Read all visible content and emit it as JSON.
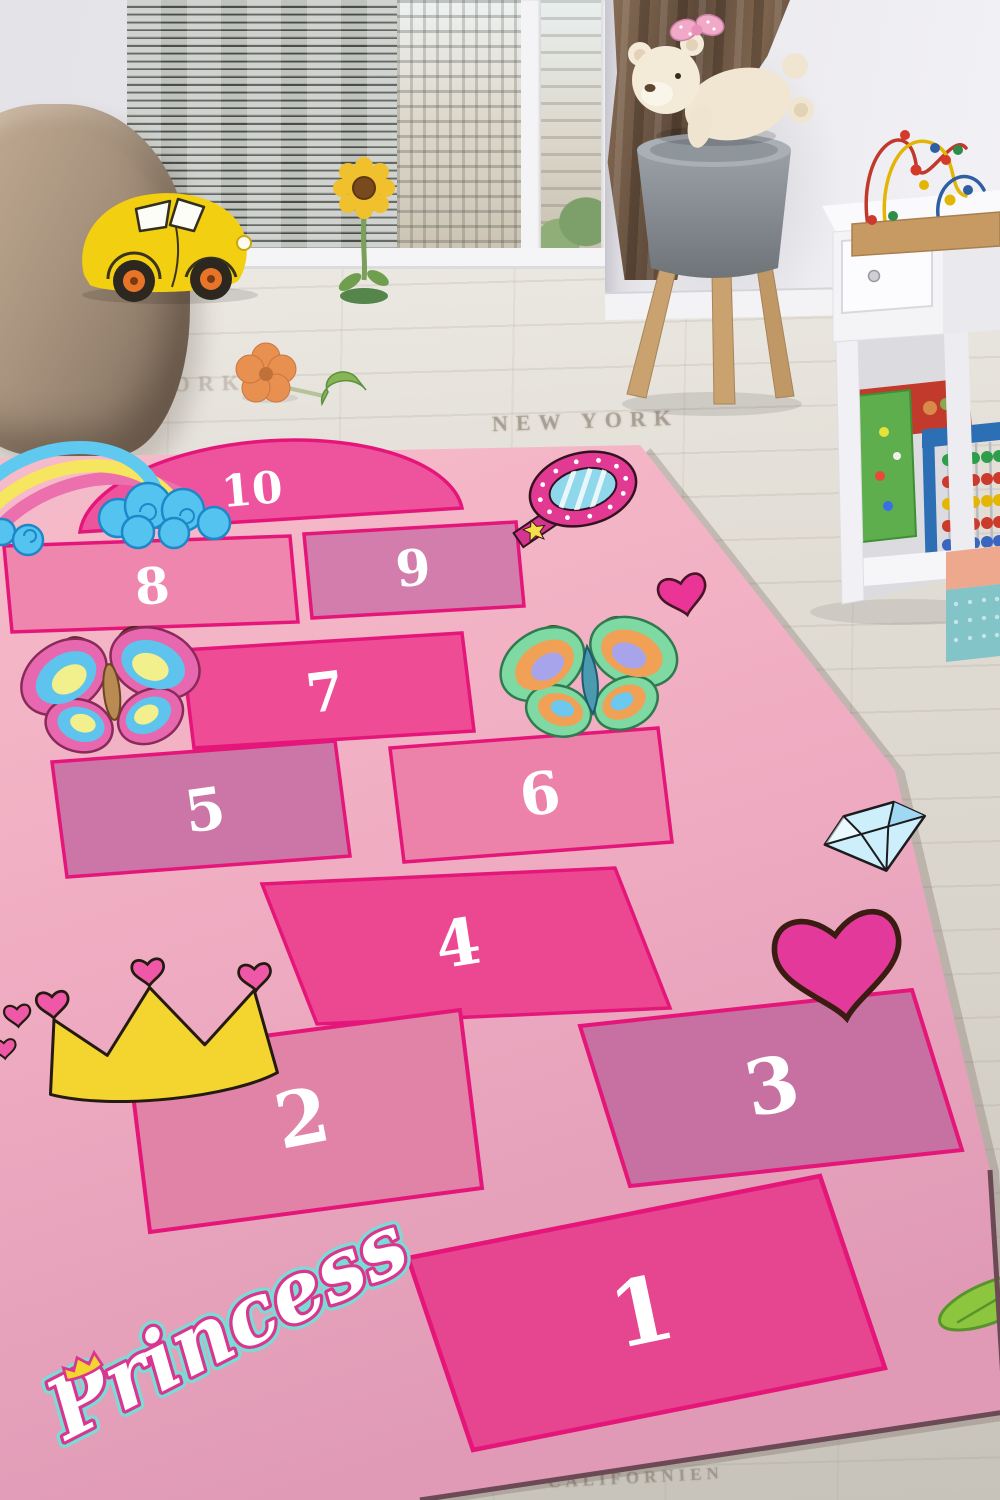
{
  "rug": {
    "title": "Princess",
    "cells": [
      {
        "number": "1",
        "fill": "#e64590"
      },
      {
        "number": "2",
        "fill": "#e083a7"
      },
      {
        "number": "3",
        "fill": "#c671a1"
      },
      {
        "number": "4",
        "fill": "#ec4791"
      },
      {
        "number": "5",
        "fill": "#cc76a7"
      },
      {
        "number": "6",
        "fill": "#ec82a9"
      },
      {
        "number": "7",
        "fill": "#ee4d96"
      },
      {
        "number": "8",
        "fill": "#ee86ad"
      },
      {
        "number": "9",
        "fill": "#d37dad"
      },
      {
        "number": "10",
        "fill": "#ee549d"
      }
    ],
    "theme": {
      "cell_border": "#e5167a",
      "number_color": "#ffffff",
      "bg_top": "#f6bcca",
      "bg_mid": "#f0adc2",
      "bg_bottom": "#e09ab6",
      "edge": "#6b4a55",
      "princess_pink": "#d93690",
      "princess_teal": "#7adcd4"
    },
    "decorations": [
      "rainbow-clouds",
      "hand-mirror",
      "small-heart",
      "butterfly-pink-blue",
      "butterfly-green-orange",
      "diamond",
      "big-heart",
      "crown-with-hearts",
      "green-leaf"
    ]
  },
  "room": {
    "floor_prints": {
      "near_window": "NEW YORK",
      "bottom": "CALIFORNIEN"
    }
  }
}
